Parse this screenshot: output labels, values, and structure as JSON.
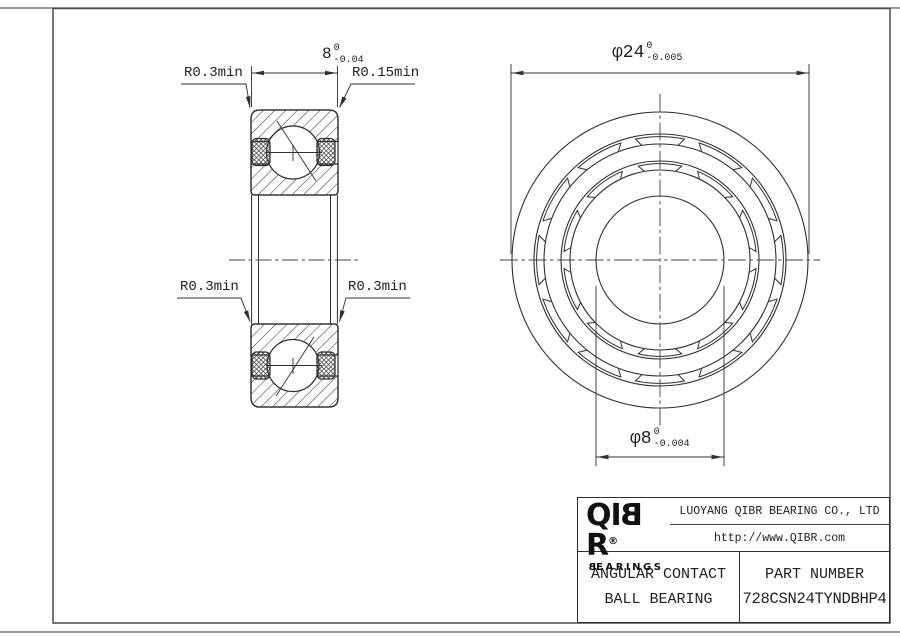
{
  "colors": {
    "line": "#2f2f2f",
    "thin_line": "#3c3c3c",
    "sheet_edge": "#8f8f8f",
    "background": "#ffffff"
  },
  "dimensions": {
    "width": {
      "text": "8",
      "tol_upper": "0",
      "tol_lower": "-0.04"
    },
    "outer_diameter": {
      "text": "φ24",
      "tol_upper": "0",
      "tol_lower": "-0.005"
    },
    "bore_diameter": {
      "text": "φ8",
      "tol_upper": "0",
      "tol_lower": "-0.004"
    },
    "radii": {
      "top_left": "R0.3min",
      "top_right": "R0.15min",
      "mid_left": "R0.3min",
      "mid_right": "R0.3min"
    }
  },
  "title_block": {
    "logo": {
      "q": "Q",
      "i": "I",
      "b": "B",
      "r": "R",
      "registered": "®",
      "sub_b": "B",
      "sub_rest": "EARINGS"
    },
    "company": "LUOYANG QIBR BEARING CO., LTD",
    "website": "http://www.QIBR.com",
    "bearing_type_line1": "ANGULAR CONTACT",
    "bearing_type_line2": "BALL BEARING",
    "part_number_label": "PART NUMBER",
    "part_number": "728CSN24TYNDBHP4"
  }
}
